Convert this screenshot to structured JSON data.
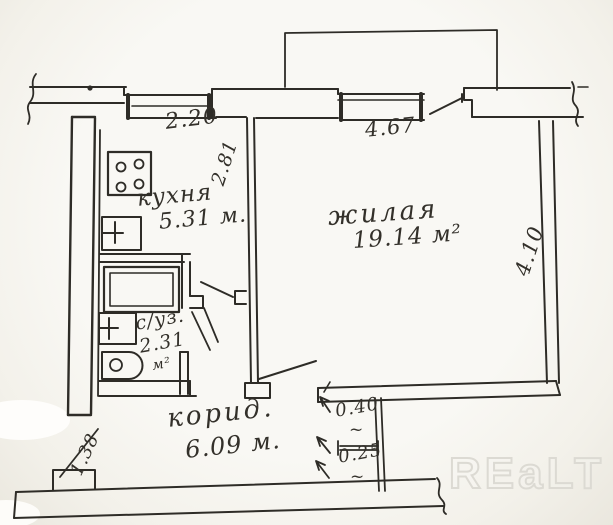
{
  "rooms": {
    "kitchen": {
      "label": "кухня",
      "area": "5.31 м."
    },
    "living": {
      "label": "жилая",
      "area": "19.14 м²"
    },
    "bathroom": {
      "label": "с/уз.",
      "area_value": "2.31",
      "area_unit": "м²"
    },
    "corridor": {
      "label": "корид.",
      "area": "6.09 м."
    }
  },
  "dimensions": {
    "kitchen_window_width": "2.20",
    "kitchen_side_depth": "2.81",
    "living_window_width": "4.67",
    "living_side_depth": "4.10",
    "entry_step_width": "1.38",
    "gap_upper": "0.40",
    "gap_upper_tilde": "~",
    "gap_lower": "0.25",
    "gap_lower_tilde": "~"
  },
  "fixtures": [
    "stove-icon",
    "kitchen-sink-icon",
    "bathtub-icon",
    "washbasin-icon",
    "toilet-icon"
  ],
  "watermark": {
    "text": "REaLT"
  },
  "colors": {
    "paper": "#f8f7f3",
    "ink": "#2e2c27",
    "watermark_outline": "#dcdad3"
  }
}
